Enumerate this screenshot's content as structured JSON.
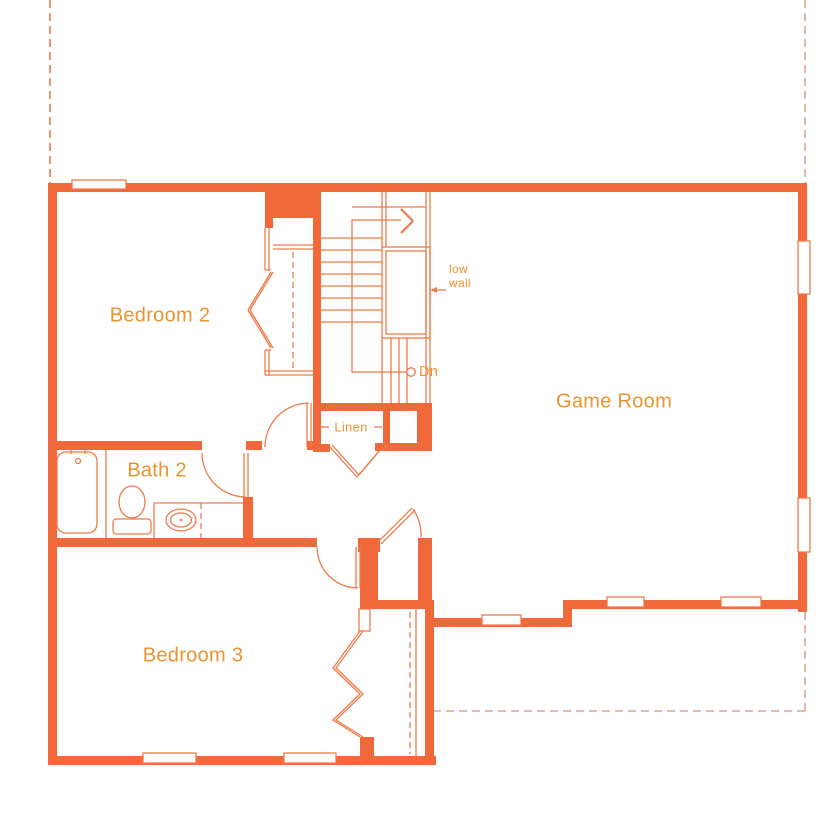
{
  "floor_plan": {
    "rooms": {
      "bedroom2": "Bedroom 2",
      "bath2": "Bath 2",
      "bedroom3": "Bedroom 3",
      "game_room": "Game Room"
    },
    "annotations": {
      "linen": "Linen",
      "down": "Dn",
      "low_wall_line1": "low",
      "low_wall_line2": "wall"
    },
    "icons": {
      "bathtub": "bathtub-icon",
      "toilet": "toilet-icon",
      "sink": "sink-vanity-icon",
      "stairs": "staircase",
      "door_swing": "door-swing-arc",
      "bifold": "bifold-closet-doors",
      "window": "window-marker",
      "closet_rod": "closet-rod-dashed"
    },
    "colors": {
      "wall": "#F1693A",
      "label": "#E9942F",
      "line": "#EE7B4A",
      "dash_left": "#EC7A50",
      "dash_right": "#DBA78D",
      "bg": "#FFFFFF"
    }
  }
}
